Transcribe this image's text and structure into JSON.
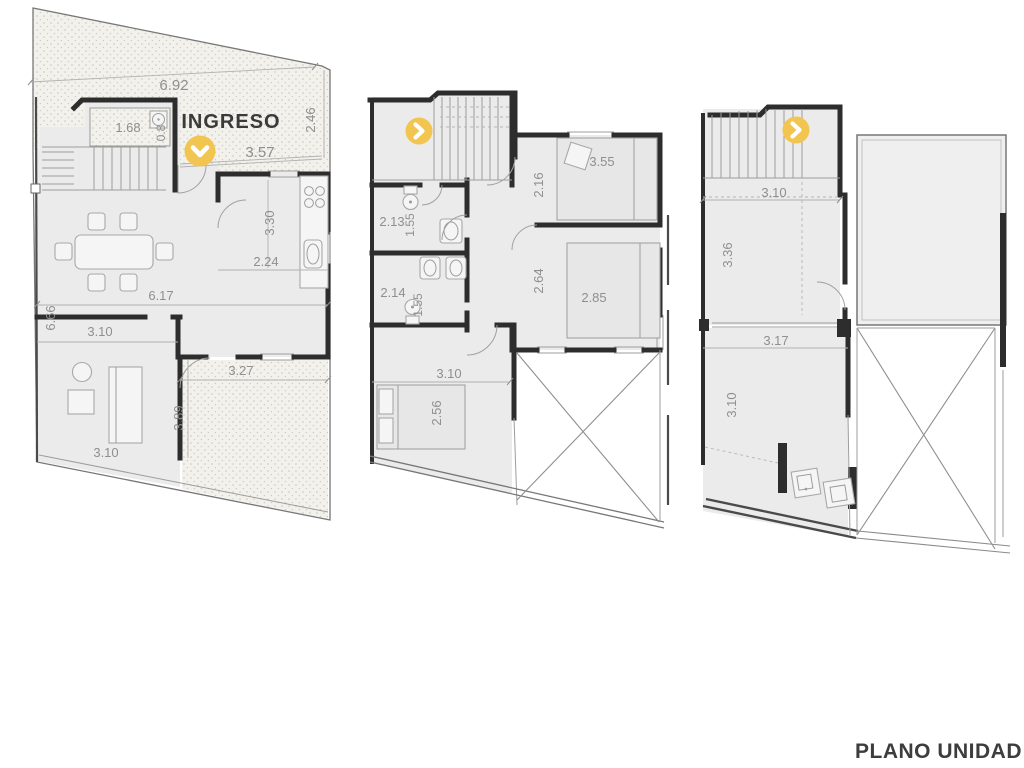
{
  "title": "PLANO UNIDAD",
  "entrance": {
    "label": "INGRESO"
  },
  "colors": {
    "accent_yellow": "#F1C550",
    "wall": "#2D2D2D",
    "dim_text": "#8F8F8F",
    "title_text": "#3D3D3D"
  },
  "markers": [
    {
      "plan": "ground-floor",
      "icon": "chevron-down",
      "color": "#F1C550"
    },
    {
      "plan": "first-floor",
      "icon": "chevron-right",
      "color": "#F1C550"
    },
    {
      "plan": "second-floor",
      "icon": "chevron-right",
      "color": "#F1C550"
    }
  ],
  "plans": {
    "ground": {
      "name": "ground-floor",
      "dims": {
        "lot_width": "6.92",
        "entry_width": "3.57",
        "front_depth": "2.46",
        "laundry_width": "1.68",
        "laundry_depth": "0.8",
        "kitchen_length": "3.30",
        "kitchen_width": "2.24",
        "living_width": "6.17",
        "living_depth": "6.66",
        "bedroom_width": "3.10",
        "bedroom_width_b": "3.10",
        "patio_width": "3.27",
        "patio_depth": "3.89"
      }
    },
    "first": {
      "name": "first-floor",
      "dims": {
        "bedroom1_width": "3.55",
        "bedroom1_depth": "2.16",
        "bath1_width": "2.13",
        "bath1_depth": "1.55",
        "bath2_width": "2.14",
        "bath2_depth": "1.55",
        "bedroom2_width": "2.85",
        "bedroom2_depth": "2.64",
        "bedroom3_width": "3.10",
        "bedroom3_depth": "2.56"
      }
    },
    "second": {
      "name": "second-floor",
      "dims": {
        "stair_width": "3.10",
        "room_depth": "3.36",
        "laundry_width": "3.17",
        "laundry_depth": "3.10"
      }
    }
  }
}
